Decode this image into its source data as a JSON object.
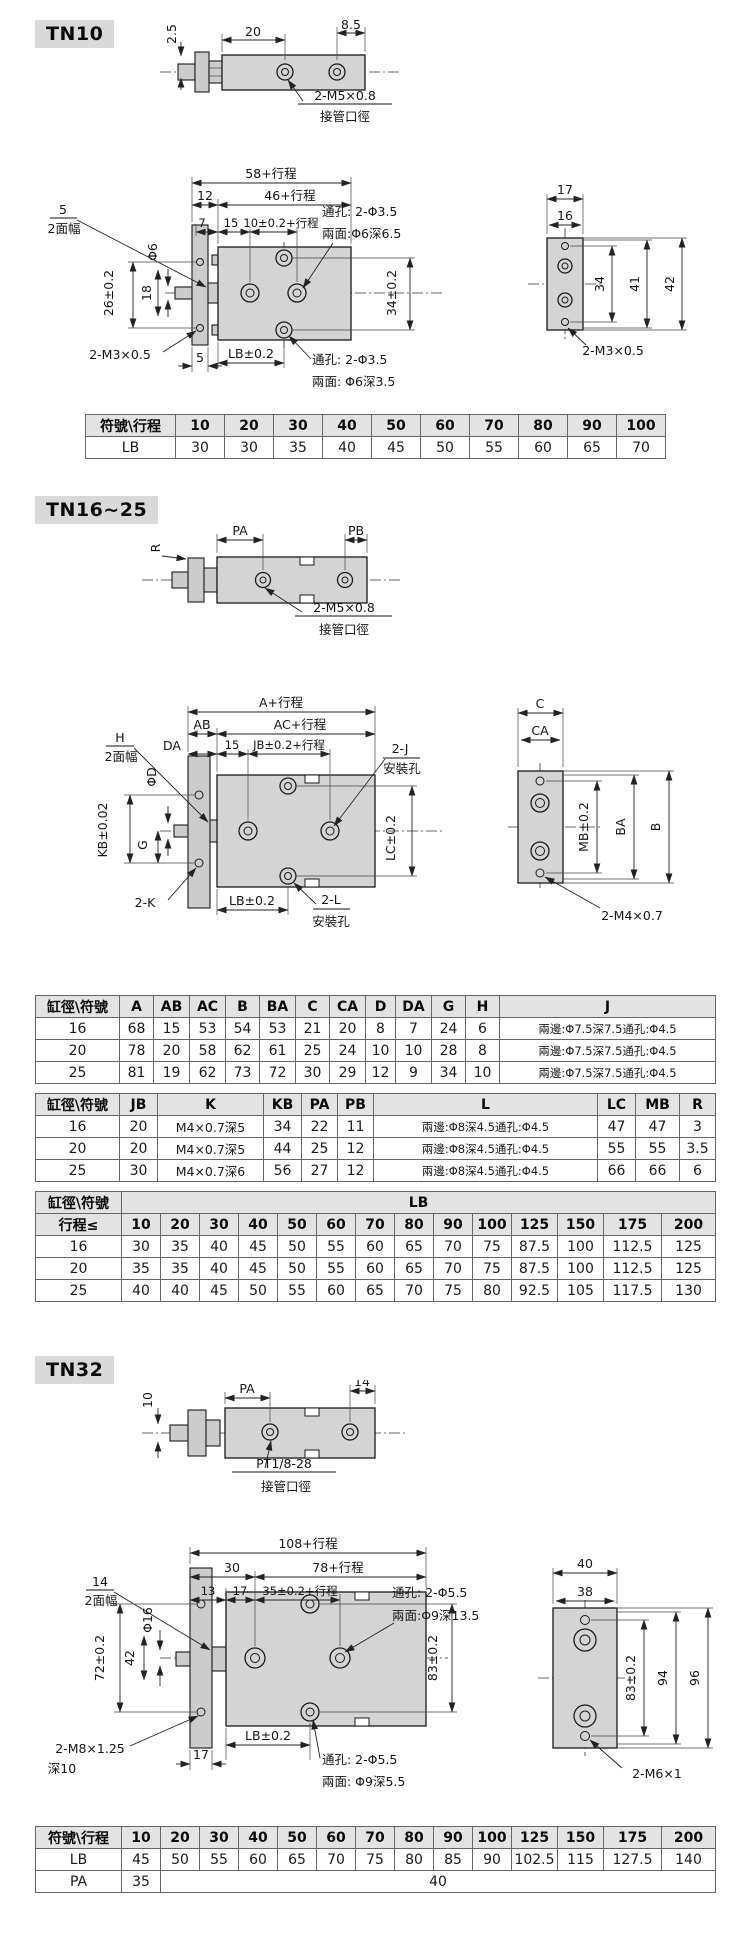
{
  "tn10": {
    "title": "TN10",
    "top": {
      "d25": "2.5",
      "d20": "20",
      "d85": "8.5",
      "port": "2-M5×0.8",
      "port_cn": "接管口徑"
    },
    "front": {
      "total": "58+行程",
      "body": "46+行程",
      "d12": "12",
      "d7": "7",
      "d15": "15",
      "pitch": "10±0.2+行程",
      "flat_n": "5",
      "flat_cn": "2面幅",
      "rod": "Φ6",
      "d26": "26±0.2",
      "d18": "18",
      "d34": "34±0.2",
      "thread": "2-M3×0.5",
      "d5": "5",
      "lb": "LB±0.2",
      "hole_t1": "通孔: 2-Φ3.5",
      "hole_t2": "兩面:Φ6深6.5",
      "hole_b1": "通孔: 2-Φ3.5",
      "hole_b2": "兩面: Φ6深3.5"
    },
    "side": {
      "d17": "17",
      "d16": "16",
      "d34": "34",
      "d41": "41",
      "d42": "42",
      "thread": "2-M3×0.5"
    },
    "table": {
      "head": [
        [
          "符號\\行程",
          "10",
          "20",
          "30",
          "40",
          "50",
          "60",
          "70",
          "80",
          "90",
          "100"
        ]
      ],
      "body": [
        [
          "LB",
          "30",
          "30",
          "35",
          "40",
          "45",
          "50",
          "55",
          "60",
          "65",
          "70"
        ]
      ]
    }
  },
  "tn16": {
    "title": "TN16~25",
    "top": {
      "r": "R",
      "pa": "PA",
      "pb": "PB",
      "port": "2-M5×0.8",
      "port_cn": "接管口徑"
    },
    "front": {
      "total": "A+行程",
      "ab": "AB",
      "ac": "AC+行程",
      "da": "DA",
      "d15": "15",
      "jb": "JB±0.2+行程",
      "flat_n": "H",
      "flat_cn": "2面幅",
      "rod": "ΦD",
      "kb": "KB±0.02",
      "g": "G",
      "j": "2-J",
      "j_cn": "安裝孔",
      "lc": "LC±0.2",
      "k": "2-K",
      "lb": "LB±0.2",
      "l": "2-L",
      "l_cn": "安裝孔"
    },
    "side": {
      "c": "C",
      "ca": "CA",
      "mb": "MB±0.2",
      "ba": "BA",
      "b": "B",
      "thread": "2-M4×0.7"
    },
    "table1": {
      "head": [
        [
          "缸徑\\符號",
          "A",
          "AB",
          "AC",
          "B",
          "BA",
          "C",
          "CA",
          "D",
          "DA",
          "G",
          "H",
          "J"
        ]
      ],
      "body": [
        [
          "16",
          "68",
          "15",
          "53",
          "54",
          "53",
          "21",
          "20",
          "8",
          "7",
          "24",
          "6",
          "兩邊:Φ7.5深7.5通孔:Φ4.5"
        ],
        [
          "20",
          "78",
          "20",
          "58",
          "62",
          "61",
          "25",
          "24",
          "10",
          "10",
          "28",
          "8",
          "兩邊:Φ7.5深7.5通孔:Φ4.5"
        ],
        [
          "25",
          "81",
          "19",
          "62",
          "73",
          "72",
          "30",
          "29",
          "12",
          "9",
          "34",
          "10",
          "兩邊:Φ7.5深7.5通孔:Φ4.5"
        ]
      ]
    },
    "table2": {
      "head": [
        [
          "缸徑\\符號",
          "JB",
          "K",
          "KB",
          "PA",
          "PB",
          "L",
          "LC",
          "MB",
          "R"
        ]
      ],
      "body": [
        [
          "16",
          "20",
          "M4×0.7深5",
          "34",
          "22",
          "11",
          "兩邊:Φ8深4.5通孔:Φ4.5",
          "47",
          "47",
          "3"
        ],
        [
          "20",
          "20",
          "M4×0.7深5",
          "44",
          "25",
          "12",
          "兩邊:Φ8深4.5通孔:Φ4.5",
          "55",
          "55",
          "3.5"
        ],
        [
          "25",
          "30",
          "M4×0.7深6",
          "56",
          "27",
          "12",
          "兩邊:Φ8深4.5通孔:Φ4.5",
          "66",
          "66",
          "6"
        ]
      ]
    },
    "table3": {
      "head": [
        [
          {
            "text": "缸徑\\符號"
          },
          {
            "text": "LB",
            "colspan": 14
          }
        ],
        [
          "行程≤",
          "10",
          "20",
          "30",
          "40",
          "50",
          "60",
          "70",
          "80",
          "90",
          "100",
          "125",
          "150",
          "175",
          "200"
        ]
      ],
      "body": [
        [
          "16",
          "30",
          "35",
          "40",
          "45",
          "50",
          "55",
          "60",
          "65",
          "70",
          "75",
          "87.5",
          "100",
          "112.5",
          "125"
        ],
        [
          "20",
          "35",
          "35",
          "40",
          "45",
          "50",
          "55",
          "60",
          "65",
          "70",
          "75",
          "87.5",
          "100",
          "112.5",
          "125"
        ],
        [
          "25",
          "40",
          "40",
          "45",
          "50",
          "55",
          "60",
          "65",
          "70",
          "75",
          "80",
          "92.5",
          "105",
          "117.5",
          "130"
        ]
      ]
    }
  },
  "tn32": {
    "title": "TN32",
    "top": {
      "d10": "10",
      "pa": "PA",
      "d14": "14",
      "port": "PT1/8-28",
      "port_cn": "接管口徑"
    },
    "front": {
      "total": "108+行程",
      "d30": "30",
      "d78": "78+行程",
      "d13": "13",
      "d17": "17",
      "pitch": "35±0.2+行程",
      "flat_n": "14",
      "flat_cn": "2面幅",
      "rod": "Φ16",
      "d72": "72±0.2",
      "d42": "42",
      "d83": "83±0.2",
      "hole_t1": "通孔: 2-Φ5.5",
      "hole_t2": "兩面:Φ9深13.5",
      "thread": "2-M8×1.25",
      "thread2": "深10",
      "d17b": "17",
      "lb": "LB±0.2",
      "hole_b1": "通孔: 2-Φ5.5",
      "hole_b2": "兩面: Φ9深5.5"
    },
    "side": {
      "d40": "40",
      "d38": "38",
      "d83": "83±0.2",
      "d94": "94",
      "d96": "96",
      "thread": "2-M6×1"
    },
    "table": {
      "head": [
        [
          "符號\\行程",
          "10",
          "20",
          "30",
          "40",
          "50",
          "60",
          "70",
          "80",
          "90",
          "100",
          "125",
          "150",
          "175",
          "200"
        ]
      ],
      "body": [
        [
          "LB",
          "45",
          "50",
          "55",
          "60",
          "65",
          "70",
          "75",
          "80",
          "85",
          "90",
          "102.5",
          "115",
          "127.5",
          "140"
        ],
        [
          {
            "text": "PA"
          },
          {
            "text": "35"
          },
          {
            "text": "40",
            "colspan": 13
          }
        ]
      ]
    }
  }
}
